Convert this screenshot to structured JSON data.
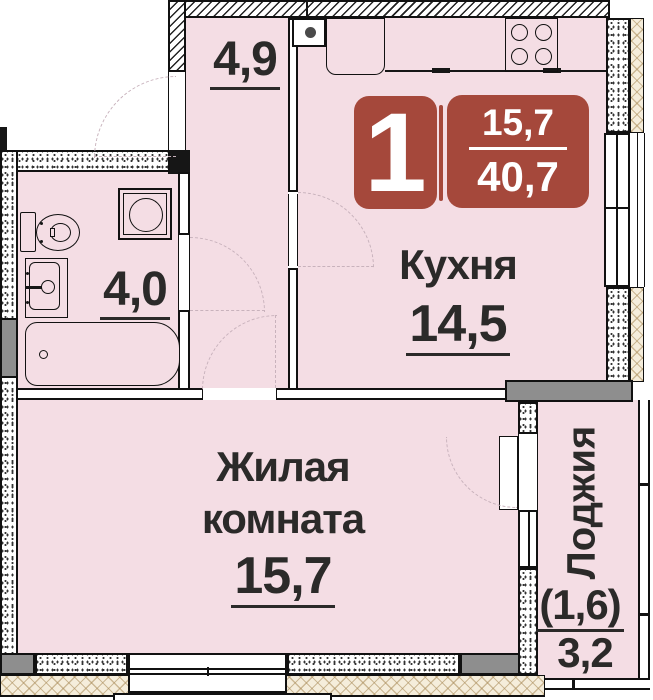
{
  "badge": {
    "rooms_count": "1",
    "area_top": "15,7",
    "area_bottom": "40,7",
    "color": "#A5483B"
  },
  "rooms": {
    "hallway": {
      "area": "4,9"
    },
    "bathroom": {
      "area": "4,0"
    },
    "kitchen": {
      "name": "Кухня",
      "area": "14,5"
    },
    "living_room": {
      "name_line1": "Жилая",
      "name_line2": "комната",
      "area": "15,7"
    },
    "loggia": {
      "name": "Лоджия",
      "area_coefficient": "(1,6)",
      "area": "3,2"
    }
  },
  "fixtures": [
    "toilet",
    "bathroom-sink",
    "bathtub",
    "washing-machine",
    "kitchen-vent",
    "fridge",
    "stove",
    "kitchen-counter"
  ],
  "colors": {
    "room_fill": "#F4DDE4",
    "wall": "#161616",
    "badge_red": "#A5483B",
    "text": "#2B2A29",
    "concrete_gray": "#8E8E8E",
    "facade_beige": "#F5EDDB"
  }
}
